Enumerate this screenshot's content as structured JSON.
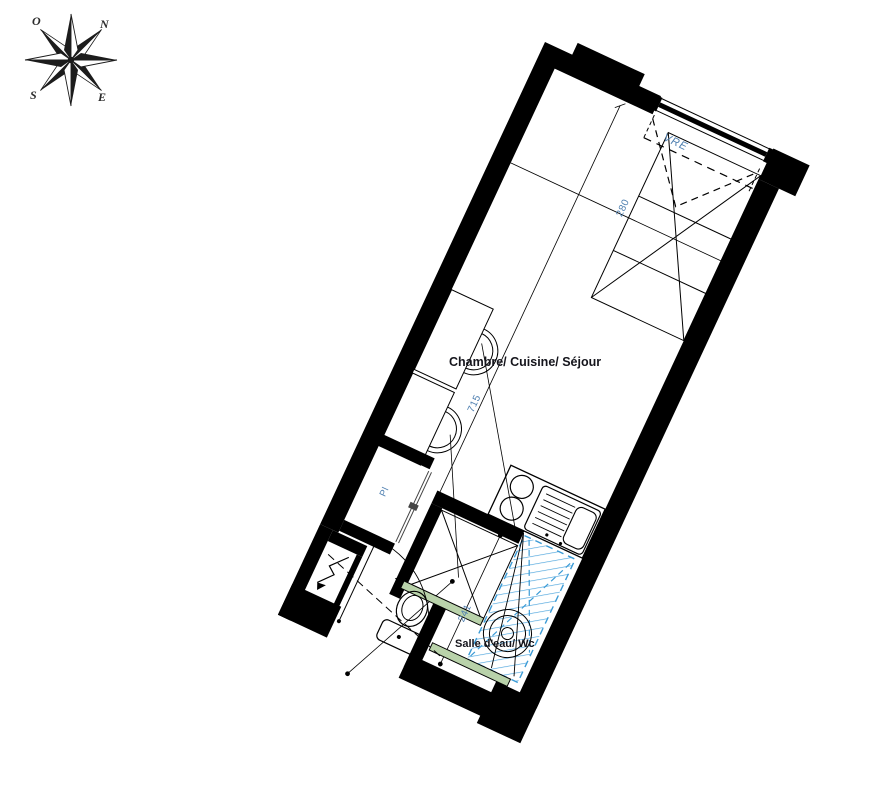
{
  "compass": {
    "north": "N",
    "south": "S",
    "east": "E",
    "west": "O"
  },
  "labels": {
    "main_room": "Chambre/ Cuisine/ Séjour",
    "bathroom": "Salle d'eau/ Wc",
    "closet": "Pl",
    "window": "VRE"
  },
  "dimensions": {
    "room_width": "280",
    "room_length": "715",
    "bathroom_width": "241"
  },
  "colors": {
    "wall": "#000000",
    "dimension_text": "#4e7fb0",
    "shower_blue": "#3b9bd6",
    "glass_green": "#b9d2aa",
    "label_text": "#15151c"
  }
}
